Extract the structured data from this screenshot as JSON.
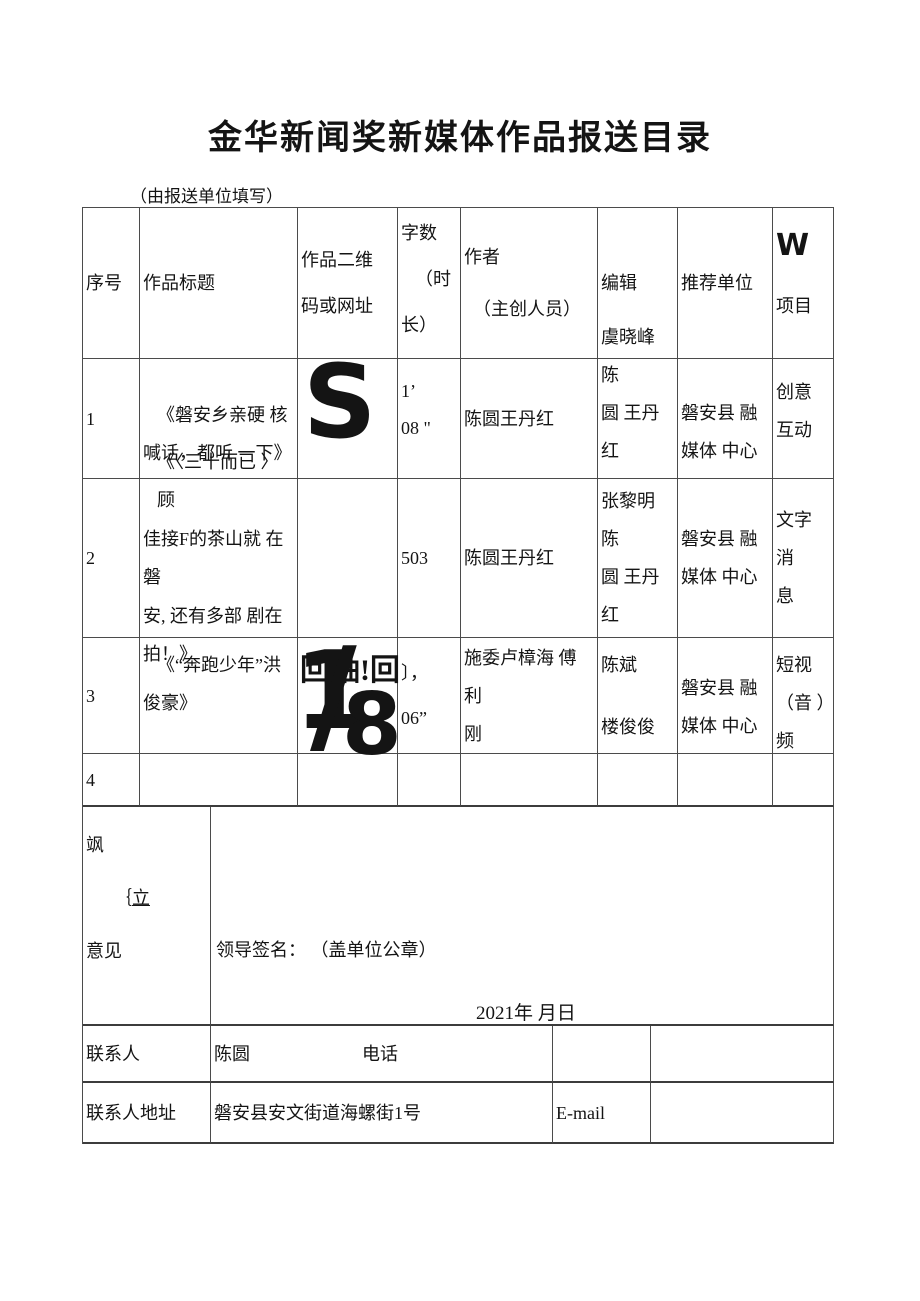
{
  "doc": {
    "title": "金华新闻奖新媒体作品报送目录",
    "note": "（由报送单位填写）"
  },
  "header": {
    "index": "序号",
    "title": "作品标题",
    "qr": [
      "作品二维",
      "码或网址"
    ],
    "count": [
      "字数",
      "（时",
      "长）"
    ],
    "author": [
      "作者",
      "（主创人员）"
    ],
    "editor": "编辑",
    "unit": "推荐单位",
    "project": [
      "W",
      "项目"
    ]
  },
  "rows": [
    {
      "index": "1",
      "title": [
        "《磐安乡亲硬 核",
        "喊话，都听 一下》"
      ],
      "qr_glyph": "S",
      "count": [
        "1’",
        "08 \""
      ],
      "author": [
        "陈圆王丹红"
      ],
      "editor": [
        "虞晓峰 陈",
        "圆 王丹红"
      ],
      "unit": [
        "磐安县 融",
        "媒体 中心"
      ],
      "project": [
        "创意",
        "互动"
      ]
    },
    {
      "index": "2",
      "title": [
        "《〈三十而已 〉 顾",
        "佳接F的茶山就 在磐",
        "安, 还有多部 剧在",
        "拍！》"
      ],
      "count": [
        "503"
      ],
      "author": [
        "陈圆王丹红"
      ],
      "editor": [
        "张黎明 陈",
        "圆 王丹红"
      ],
      "unit": [
        "磐安县 融",
        "媒体 中心"
      ],
      "project": [
        "文字 消",
        "息"
      ]
    },
    {
      "index": "3",
      "title": [
        "《“奔跑少年”洪",
        "俊豪》"
      ],
      "qr_glitch": {
        "text": "回轴!回",
        "one": "1",
        "slash": "/",
        "eight": "8"
      },
      "count": [
        "〕，",
        "06”"
      ],
      "author": [
        "施委卢樟海 傅利",
        "刚"
      ],
      "editor": [
        "陈斌",
        "楼俊俊"
      ],
      "unit": [
        "磐安县 融",
        "媒体 中心"
      ],
      "project": [
        "短视",
        "（音 ）",
        "频"
      ]
    },
    {
      "index": "4"
    }
  ],
  "opinion": {
    "label_line1": "飒",
    "label_line2_prefix": "｛",
    "label_line2_underlined": "立",
    "label_line3": "意见",
    "signature": "领导签名： （盖单位公章）",
    "date": "2021年 月日"
  },
  "contact": {
    "person_label": "联系人",
    "person_value": "陈圆",
    "phone_label": "电话",
    "address_label": "联系人地址",
    "address_value": "磐安县安文街道海螺街1号",
    "email_label": "E-mail"
  }
}
